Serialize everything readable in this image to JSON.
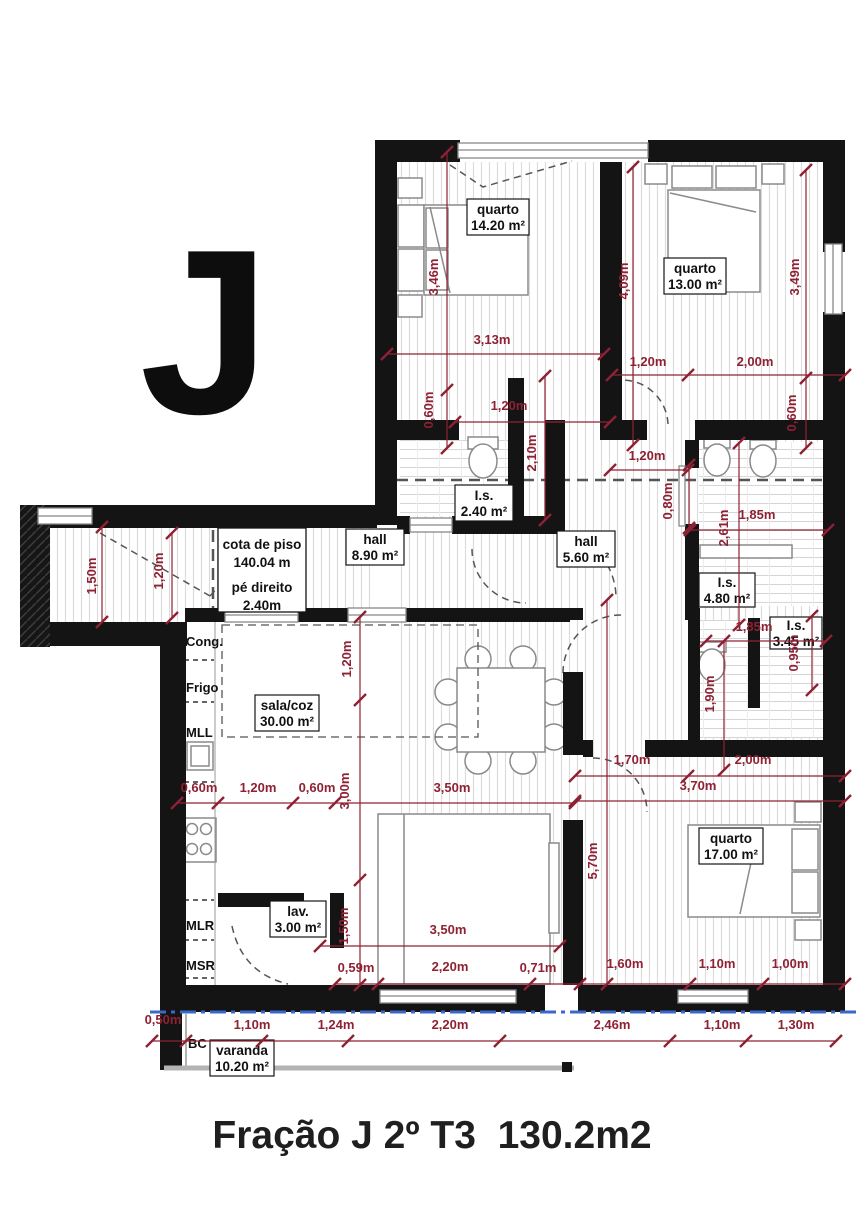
{
  "title": {
    "letter": "J",
    "caption": "Fração J 2º T3  130.2m2"
  },
  "colors": {
    "wall": "#141414",
    "dim": "#8e2133",
    "floor_stripe": "#dcdcdc",
    "blue_line": "#3a67c9",
    "dash": "#555555"
  },
  "info_box": {
    "l1": "cota de piso",
    "l2": "140.04 m",
    "l3": "pé direito",
    "l4": "2.40m"
  },
  "rooms": [
    {
      "name": "quarto",
      "area": "14.20 m²",
      "x": 498,
      "y": 217,
      "w": 62,
      "h": 36
    },
    {
      "name": "quarto",
      "area": "13.00 m²",
      "x": 695,
      "y": 276,
      "w": 62,
      "h": 36
    },
    {
      "name": "I.s.",
      "area": "2.40 m²",
      "x": 484,
      "y": 503,
      "w": 58,
      "h": 36
    },
    {
      "name": "hall",
      "area": "8.90 m²",
      "x": 375,
      "y": 547,
      "w": 58,
      "h": 36
    },
    {
      "name": "hall",
      "area": "5.60 m²",
      "x": 586,
      "y": 549,
      "w": 58,
      "h": 36
    },
    {
      "name": "I.s.",
      "area": "4.80 m²",
      "x": 727,
      "y": 590,
      "w": 56,
      "h": 34
    },
    {
      "name": "I.s.",
      "area": "3.45 m²",
      "x": 796,
      "y": 633,
      "w": 52,
      "h": 32
    },
    {
      "name": "sala/coz",
      "area": "30.00 m²",
      "x": 287,
      "y": 713,
      "w": 64,
      "h": 36
    },
    {
      "name": "quarto",
      "area": "17.00 m²",
      "x": 731,
      "y": 846,
      "w": 64,
      "h": 36
    },
    {
      "name": "lav.",
      "area": "3.00 m²",
      "x": 298,
      "y": 919,
      "w": 56,
      "h": 36
    },
    {
      "name": "varanda",
      "area": "10.20 m²",
      "x": 242,
      "y": 1058,
      "w": 64,
      "h": 36
    }
  ],
  "appliances": [
    {
      "label": "Cong.",
      "x": 186,
      "y": 646
    },
    {
      "label": "Frigo",
      "x": 186,
      "y": 692
    },
    {
      "label": "MLL",
      "x": 186,
      "y": 737
    },
    {
      "label": "MLR",
      "x": 186,
      "y": 930
    },
    {
      "label": "MSR",
      "x": 186,
      "y": 970
    },
    {
      "label": "BC",
      "x": 188,
      "y": 1048
    }
  ],
  "dims": [
    {
      "t": "3,13m",
      "x": 492,
      "y": 344,
      "r": 0,
      "ln": [
        387,
        354,
        604,
        354
      ]
    },
    {
      "t": "1,20m",
      "x": 648,
      "y": 366,
      "r": 0,
      "ln": [
        612,
        375,
        845,
        375
      ],
      "tk": [
        [
          688,
          375
        ]
      ]
    },
    {
      "t": "2,00m",
      "x": 755,
      "y": 366,
      "r": 0
    },
    {
      "t": "1,20m",
      "x": 509,
      "y": 410,
      "r": 0,
      "ln": [
        455,
        422,
        610,
        422
      ]
    },
    {
      "t": "1,20m",
      "x": 647,
      "y": 460,
      "r": 0,
      "ln": [
        610,
        470,
        688,
        470
      ]
    },
    {
      "t": "1,85m",
      "x": 757,
      "y": 519,
      "r": 0,
      "ln": [
        690,
        530,
        828,
        530
      ]
    },
    {
      "t": "1,85m",
      "x": 754,
      "y": 631,
      "r": 0,
      "ln": [
        706,
        641,
        826,
        641
      ]
    },
    {
      "t": "1,70m",
      "x": 632,
      "y": 764,
      "r": 0,
      "ln": [
        575,
        776,
        845,
        776
      ],
      "tk": [
        [
          688,
          776
        ]
      ]
    },
    {
      "t": "2,00m",
      "x": 753,
      "y": 764,
      "r": 0
    },
    {
      "t": "3,70m",
      "x": 698,
      "y": 790,
      "r": 0,
      "ln": [
        575,
        801,
        845,
        801
      ]
    },
    {
      "t": "0,60m",
      "x": 199,
      "y": 792,
      "r": 0,
      "ln": [
        177,
        803,
        575,
        803
      ],
      "tk": [
        [
          218,
          803
        ],
        [
          293,
          803
        ],
        [
          335,
          803
        ]
      ]
    },
    {
      "t": "1,20m",
      "x": 258,
      "y": 792,
      "r": 0
    },
    {
      "t": "0,60m",
      "x": 317,
      "y": 792,
      "r": 0
    },
    {
      "t": "3,50m",
      "x": 452,
      "y": 792,
      "r": 0
    },
    {
      "t": "3,50m",
      "x": 448,
      "y": 934,
      "r": 0,
      "ln": [
        320,
        946,
        560,
        946
      ]
    },
    {
      "t": "0,59m",
      "x": 356,
      "y": 972,
      "r": 0,
      "ln": [
        335,
        984,
        845,
        984
      ],
      "tk": [
        [
          378,
          984
        ],
        [
          530,
          984
        ],
        [
          580,
          984
        ],
        [
          690,
          984
        ],
        [
          763,
          984
        ]
      ]
    },
    {
      "t": "2,20m",
      "x": 450,
      "y": 971,
      "r": 0
    },
    {
      "t": "0,71m",
      "x": 538,
      "y": 972,
      "r": 0
    },
    {
      "t": "1,60m",
      "x": 625,
      "y": 968,
      "r": 0
    },
    {
      "t": "1,10m",
      "x": 717,
      "y": 968,
      "r": 0
    },
    {
      "t": "1,00m",
      "x": 790,
      "y": 968,
      "r": 0
    },
    {
      "t": "0,50m",
      "x": 163,
      "y": 1024,
      "r": 0,
      "ln": [
        152,
        1041,
        836,
        1041
      ],
      "tk": [
        [
          186,
          1041
        ],
        [
          262,
          1041
        ],
        [
          348,
          1041
        ],
        [
          500,
          1041
        ],
        [
          670,
          1041
        ],
        [
          746,
          1041
        ]
      ]
    },
    {
      "t": "1,10m",
      "x": 252,
      "y": 1029,
      "r": 0
    },
    {
      "t": "1,24m",
      "x": 336,
      "y": 1029,
      "r": 0
    },
    {
      "t": "2,20m",
      "x": 450,
      "y": 1029,
      "r": 0
    },
    {
      "t": "2,46m",
      "x": 612,
      "y": 1029,
      "r": 0
    },
    {
      "t": "1,10m",
      "x": 722,
      "y": 1029,
      "r": 0
    },
    {
      "t": "1,30m",
      "x": 796,
      "y": 1029,
      "r": 0
    },
    {
      "t": "3,46m",
      "x": 438,
      "y": 277,
      "r": -90,
      "ln": [
        447,
        152,
        447,
        448
      ],
      "tk": [
        [
          447,
          390
        ]
      ]
    },
    {
      "t": "0,60m",
      "x": 433,
      "y": 410,
      "r": -90
    },
    {
      "t": "4,09m",
      "x": 628,
      "y": 281,
      "r": -90,
      "ln": [
        633,
        167,
        633,
        445
      ]
    },
    {
      "t": "3,49m",
      "x": 799,
      "y": 277,
      "r": -90,
      "ln": [
        806,
        170,
        806,
        448
      ],
      "tk": [
        [
          806,
          378
        ]
      ]
    },
    {
      "t": "0,60m",
      "x": 796,
      "y": 413,
      "r": -90
    },
    {
      "t": "2,10m",
      "x": 536,
      "y": 453,
      "r": -90,
      "ln": [
        545,
        376,
        545,
        520
      ]
    },
    {
      "t": "0,80m",
      "x": 672,
      "y": 501,
      "r": -90,
      "ln": [
        689,
        465,
        689,
        528
      ]
    },
    {
      "t": "2,61m",
      "x": 728,
      "y": 528,
      "r": -90,
      "ln": [
        739,
        443,
        739,
        625
      ]
    },
    {
      "t": "1,50m",
      "x": 96,
      "y": 576,
      "r": -90,
      "ln": [
        102,
        527,
        102,
        622
      ]
    },
    {
      "t": "1,20m",
      "x": 163,
      "y": 571,
      "r": -90,
      "ln": [
        172,
        533,
        172,
        618
      ]
    },
    {
      "t": "1,20m",
      "x": 351,
      "y": 659,
      "r": -90,
      "ln": [
        360,
        617,
        360,
        985
      ],
      "tk": [
        [
          360,
          700
        ],
        [
          360,
          880
        ]
      ]
    },
    {
      "t": "3,00m",
      "x": 349,
      "y": 791,
      "r": -90
    },
    {
      "t": "1,50m",
      "x": 348,
      "y": 926,
      "r": -90
    },
    {
      "t": "0,95m",
      "x": 798,
      "y": 653,
      "r": -90,
      "ln": [
        812,
        616,
        812,
        690
      ]
    },
    {
      "t": "1,90m",
      "x": 714,
      "y": 694,
      "r": -90,
      "ln": [
        724,
        641,
        724,
        770
      ]
    },
    {
      "t": "5,70m",
      "x": 597,
      "y": 861,
      "r": -90,
      "ln": [
        607,
        600,
        607,
        984
      ]
    }
  ]
}
